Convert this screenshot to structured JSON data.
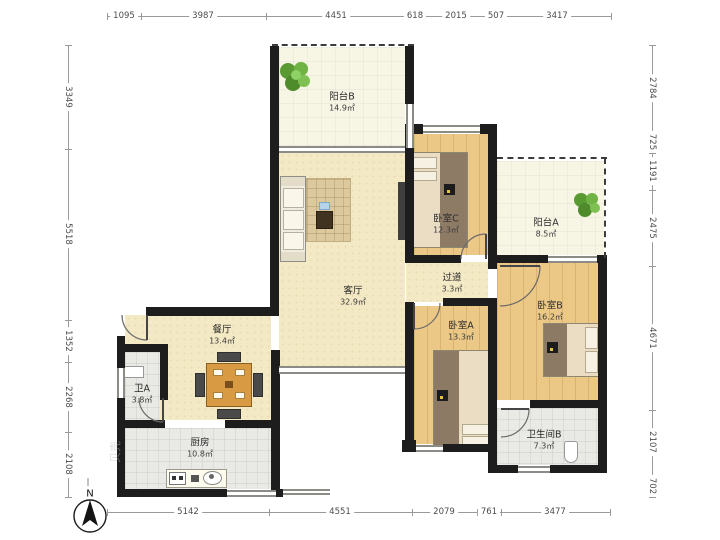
{
  "plan": {
    "title": "apartment-floor-plan",
    "rooms": [
      {
        "id": "balcony-b",
        "name": "阳台B",
        "area": "14.9㎡"
      },
      {
        "id": "living-room",
        "name": "客厅",
        "area": "32.9㎡"
      },
      {
        "id": "dining-room",
        "name": "餐厅",
        "area": "13.4㎡"
      },
      {
        "id": "bathroom-a",
        "name": "卫A",
        "area": "3.8㎡"
      },
      {
        "id": "kitchen",
        "name": "厨房",
        "area": "10.8㎡"
      },
      {
        "id": "bedroom-c",
        "name": "卧室C",
        "area": "12.3㎡"
      },
      {
        "id": "corridor",
        "name": "过道",
        "area": "3.3㎡"
      },
      {
        "id": "bedroom-a",
        "name": "卧室A",
        "area": "13.3㎡"
      },
      {
        "id": "bedroom-b",
        "name": "卧室B",
        "area": "16.2㎡"
      },
      {
        "id": "balcony-a",
        "name": "阳台A",
        "area": "8.5㎡"
      },
      {
        "id": "bathroom-b",
        "name": "卫生间B",
        "area": "7.3㎡"
      }
    ],
    "dimensions": {
      "top": [
        "1095",
        "3987",
        "4451",
        "618",
        "2015",
        "507",
        "3417"
      ],
      "bottom": [
        "5142",
        "4551",
        "2079",
        "761",
        "3477"
      ],
      "left": [
        "3349",
        "5518",
        "1352",
        "2268",
        "2108"
      ],
      "right": [
        "2784",
        "725",
        "1191",
        "2475",
        "4671",
        "2107",
        "702"
      ]
    },
    "compass": {
      "label": "N"
    },
    "watermark": "贝壳",
    "colors": {
      "wall": "#1d1d1d",
      "wood_floor": "#ecc886",
      "living_floor": "#f4e9c5",
      "tile_floor": "#e9e9e5",
      "table_wood": "#d89b44",
      "plant_green": "#5a9a33"
    }
  }
}
